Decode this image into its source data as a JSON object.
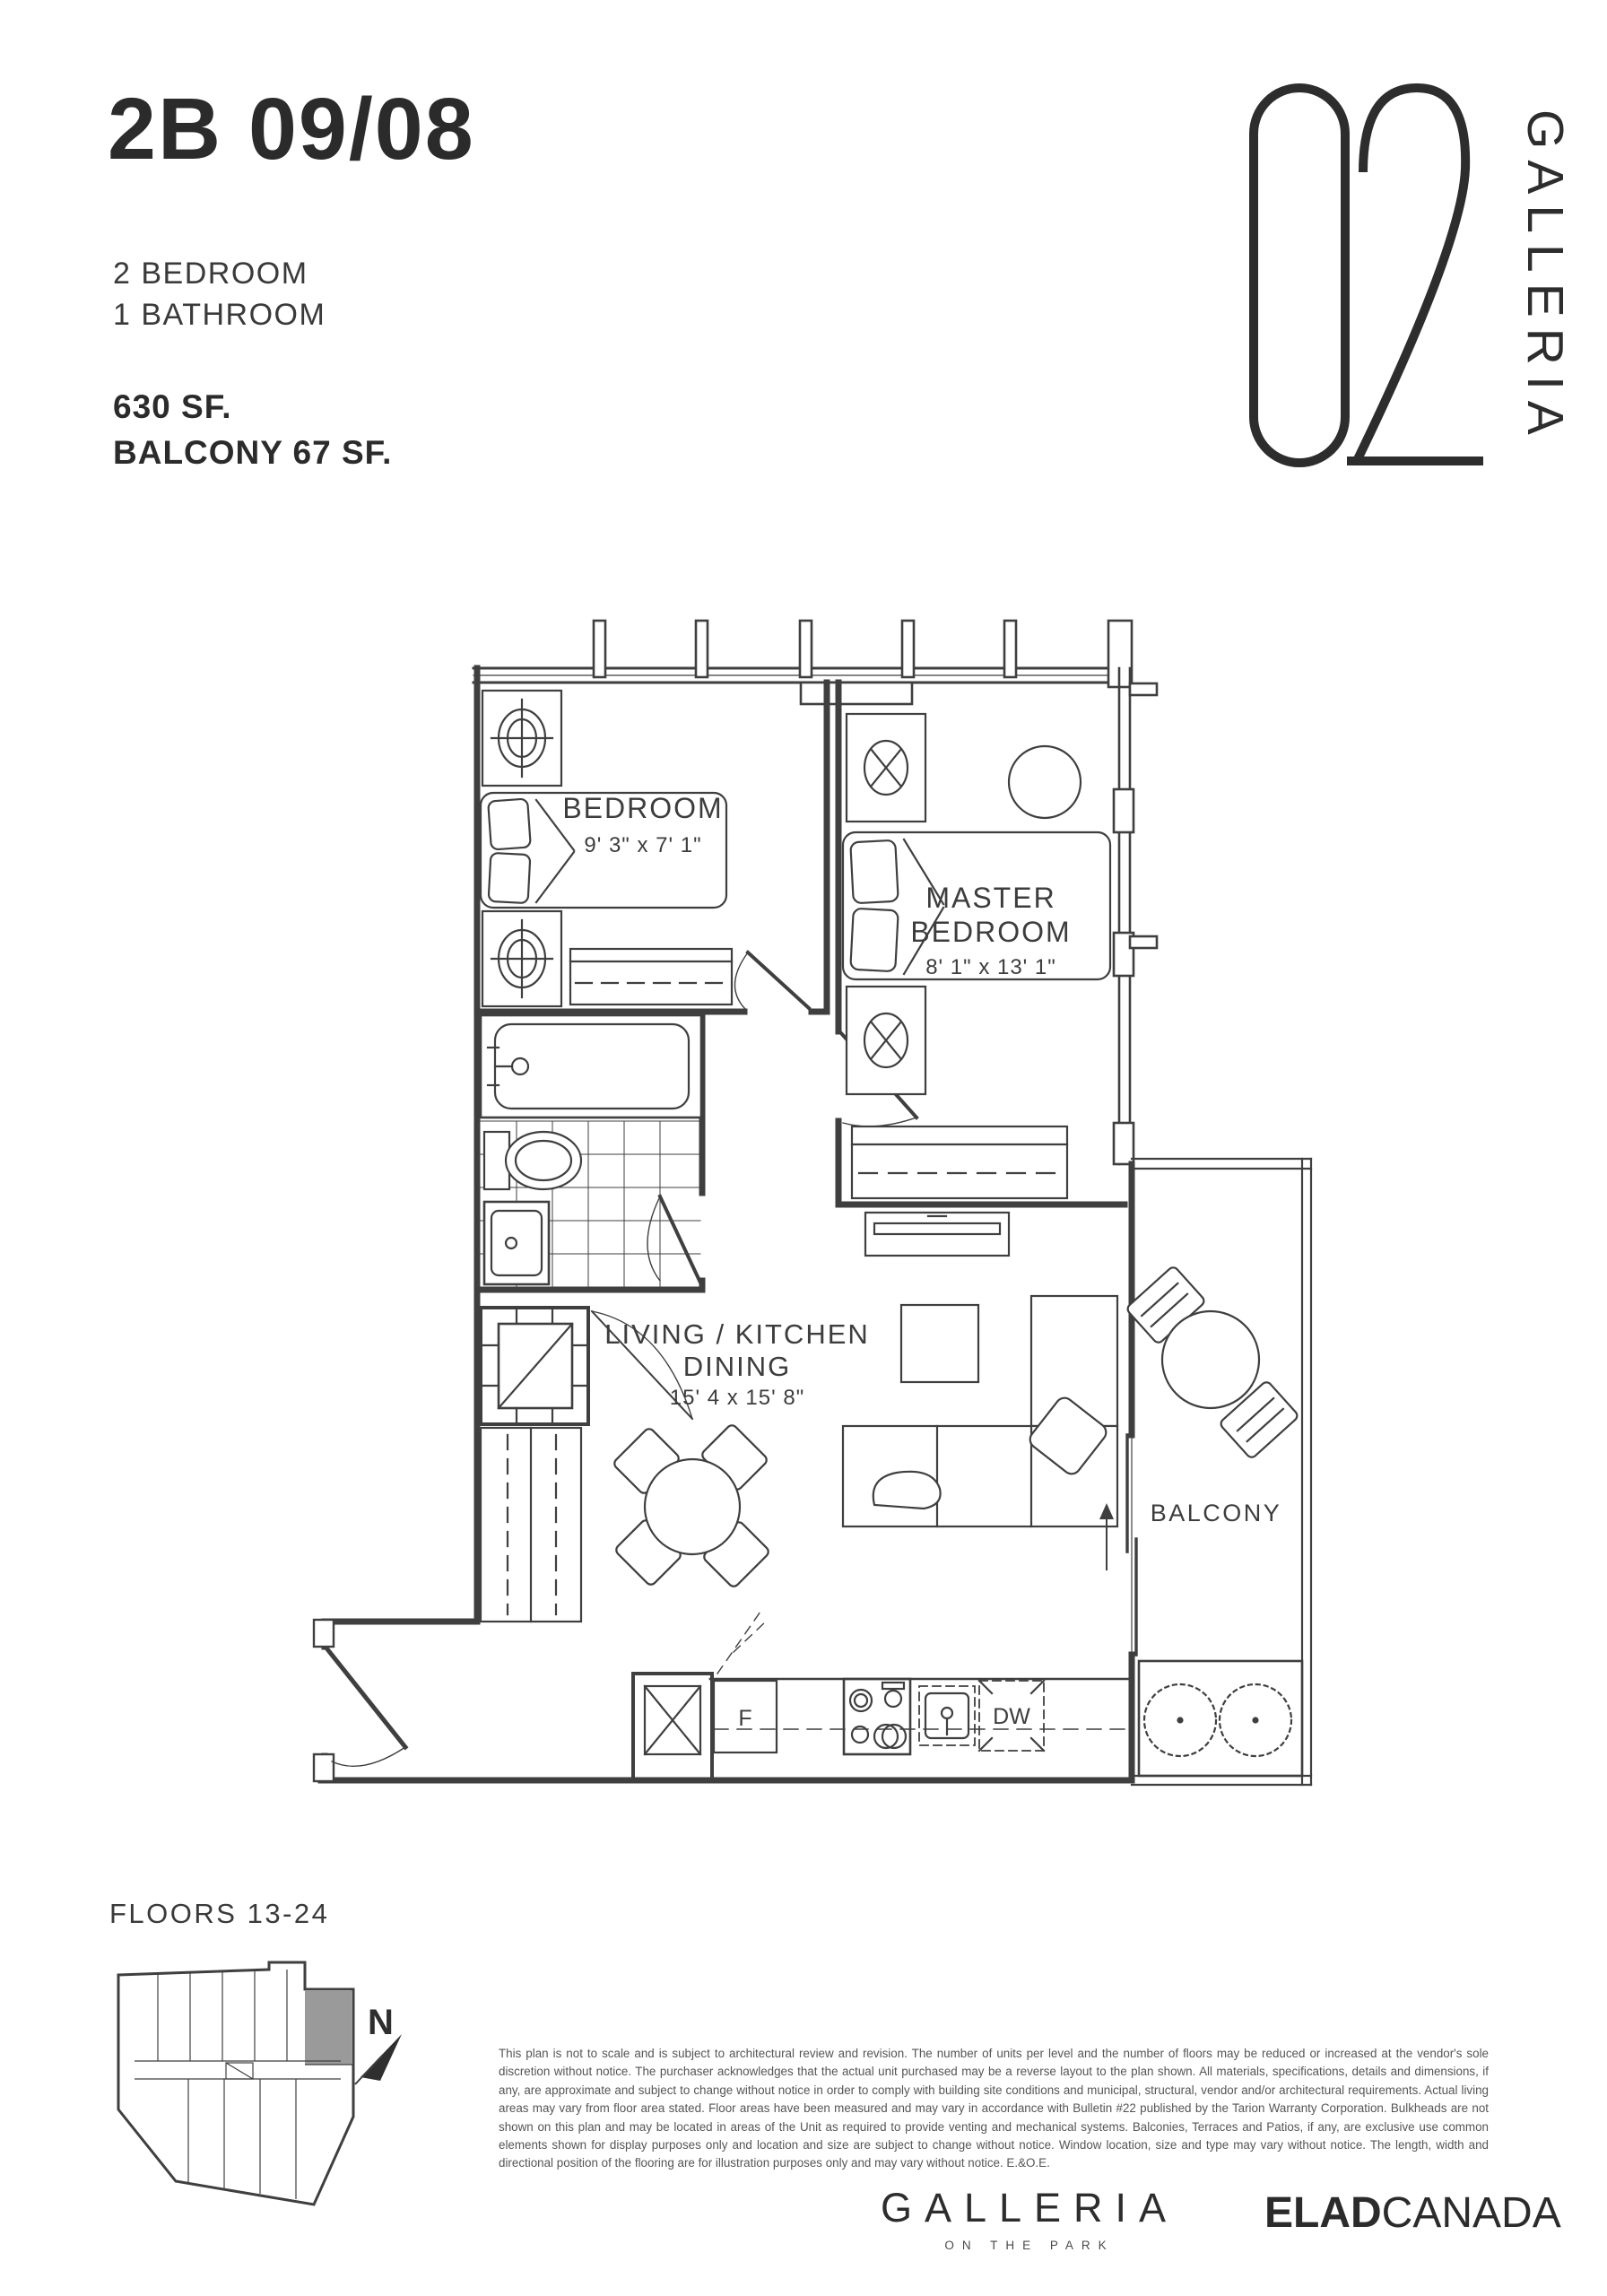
{
  "header": {
    "unit_code": "2B 09/08",
    "bedrooms": "2 BEDROOM",
    "bathrooms": "1 BATHROOM",
    "area": "630 SF.",
    "balcony_area": "BALCONY 67 SF."
  },
  "brand": {
    "number": "02",
    "name_vertical": "GALLERIA"
  },
  "floorplan": {
    "rooms": [
      {
        "name": "BEDROOM",
        "dims": "9' 3\" x 7' 1\""
      },
      {
        "lines": [
          "MASTER",
          "BEDROOM"
        ],
        "dims": "8' 1\" x 13' 1\""
      },
      {
        "lines": [
          "LIVING / KITCHEN",
          "DINING"
        ],
        "dims": "15' 4 x 15' 8\""
      },
      {
        "name": "BALCONY"
      }
    ],
    "appliances": {
      "fridge": "F",
      "dishwasher": "DW"
    }
  },
  "keyplan": {
    "label": "FLOORS 13-24",
    "north": "N",
    "highlight_color": "#9a9a9a"
  },
  "disclaimer": "This plan is not to scale and is subject to architectural review and revision. The number of units per level and the number of floors may be reduced or increased at the vendor's sole discretion without notice. The purchaser acknowledges that the actual unit purchased may be a reverse layout to the plan shown. All materials, specifications, details and dimensions, if any, are approximate and subject to change without notice in order to comply with building site conditions and municipal, structural, vendor and/or architectural requirements. Actual living areas may vary from floor area stated. Floor areas have been measured and may vary in accordance with Bulletin #22 published by the Tarion Warranty Corporation. Bulkheads are not shown on this plan and may be located in areas of the Unit as required to provide venting and mechanical systems. Balconies, Terraces and Patios, if any, are exclusive use common elements shown for display purposes only and location and size are subject to change without notice. Window location, size and type may vary without notice. The length, width and directional position of the flooring are for illustration purposes only and may vary without notice. E.&O.E.",
  "footer": {
    "project": "GALLERIA",
    "tagline": "ON THE PARK",
    "developer_bold": "ELAD",
    "developer_light": "CANADA"
  }
}
